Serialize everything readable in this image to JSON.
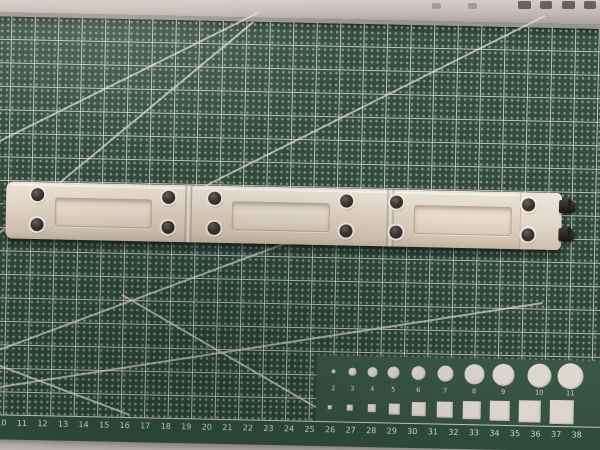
{
  "scene": {
    "description": "White plastic Technic-style beam assembly of three linked panels with pin holes and two black connector pins on its right end, lying horizontally on a dark green self-healing cutting mat; grey ruler/desk strip with blurred dark marks along the top edge and light desk surface below the mat"
  },
  "colors": {
    "mat_base": "#2c4839",
    "mat_grid_line": "#ded7cf",
    "mat_shapes_panel": "#3a5947",
    "shape_fill": "#ece4dc",
    "beam_body": "#e9ddcd",
    "beam_hole": "#332c25",
    "connector_pin": "#262422",
    "desk_surface": "#d3cac5",
    "top_strip": "#b5aba9"
  },
  "cutting_mat": {
    "ruler_numbers": [
      "10",
      "11",
      "12",
      "13",
      "14",
      "15",
      "16",
      "17",
      "18",
      "19",
      "20",
      "21",
      "22",
      "23",
      "24",
      "25",
      "26",
      "27",
      "28",
      "29",
      "30",
      "31",
      "32",
      "33",
      "34",
      "35",
      "36",
      "37",
      "38"
    ],
    "circle_labels": [
      "2",
      "3",
      "4",
      "5",
      "6",
      "7",
      "8",
      "9",
      "10",
      "11"
    ]
  },
  "beam_assembly": {
    "segment_count": 3,
    "pin_count": 2
  }
}
